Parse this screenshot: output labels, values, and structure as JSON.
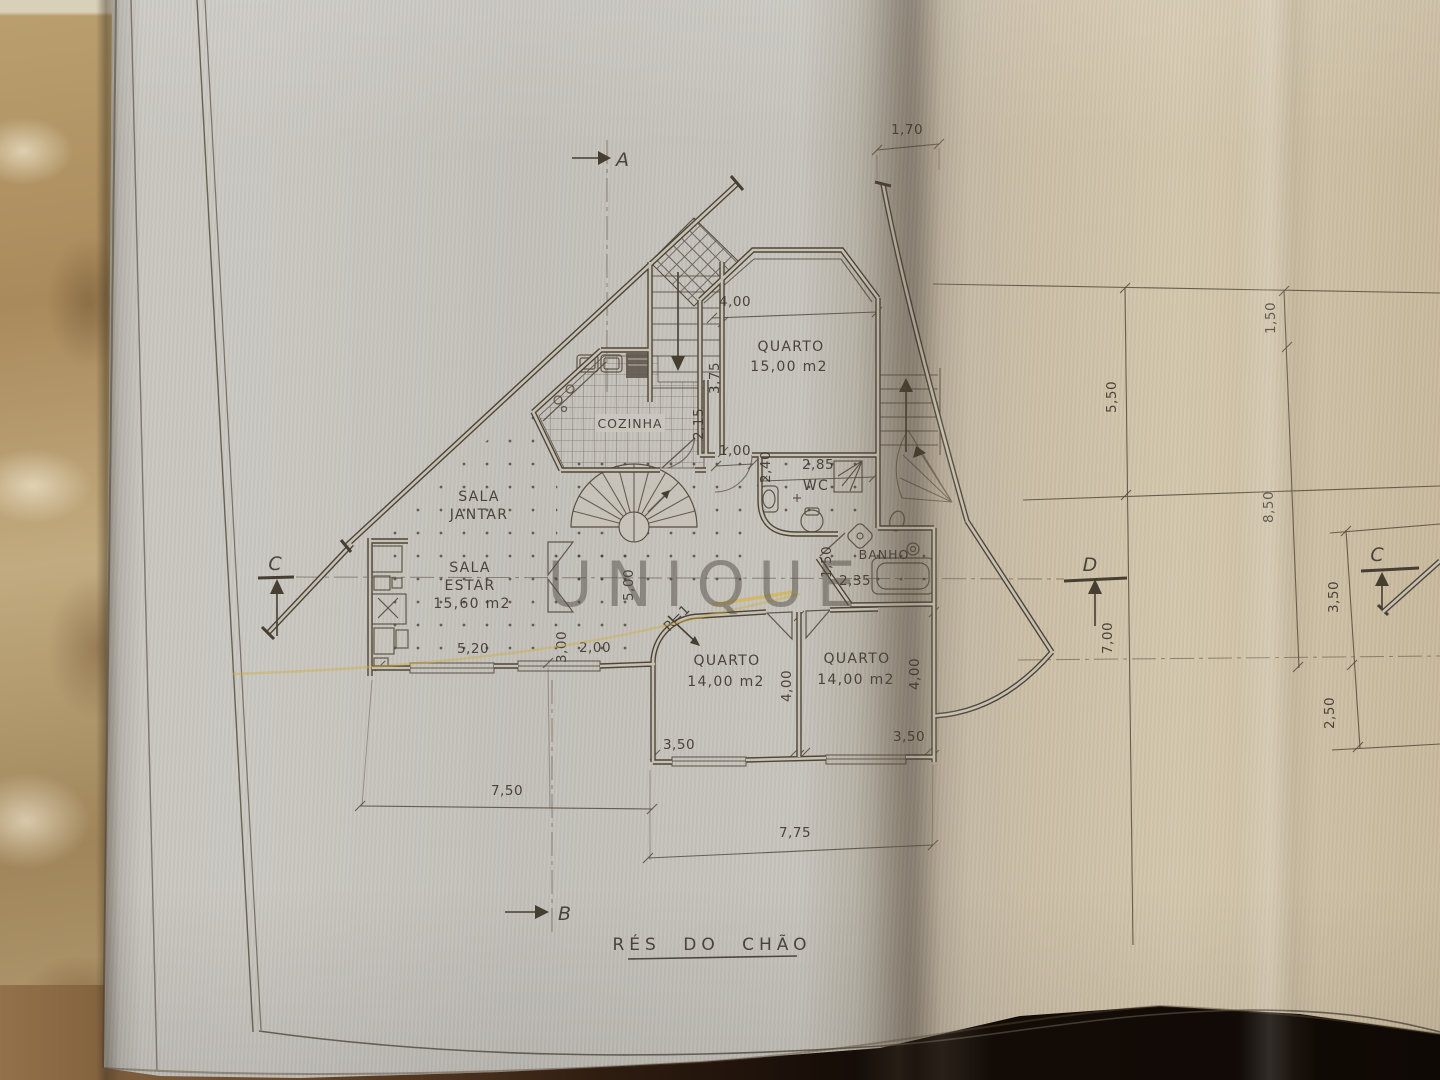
{
  "watermark": "UNIQUE",
  "title": "RÉS DO CHÃO",
  "sections": {
    "a": "A",
    "b": "B",
    "c": "C",
    "d": "D",
    "c_right": "C"
  },
  "rooms": {
    "bedroom_top": {
      "name": "QUARTO",
      "area": "15,00 m2"
    },
    "kitchen": "COZINHA",
    "wc": "WC",
    "bath": "BANHO",
    "dining": {
      "line1": "SALA",
      "line2": "JANTAR"
    },
    "living": {
      "line1": "SALA",
      "line2": "ESTAR",
      "area": "15,60 m2"
    },
    "bedroom_left": {
      "name": "QUARTO",
      "area": "14,00 m2"
    },
    "bedroom_right": {
      "name": "QUARTO",
      "area": "14,00 m2"
    }
  },
  "dims": {
    "top_400": "4,00",
    "depth_375": "3,75",
    "v215": "2,15",
    "h100": "1,00",
    "v240": "2,40",
    "h285": "2,85",
    "top_170": "1,70",
    "h520": "5,20",
    "v300": "3,00",
    "h200": "2,00",
    "v500": "5,00",
    "v150": "1,50",
    "h235": "2,35",
    "v400_mid": "4,00",
    "v400_right": "4,00",
    "h350_left": "3,50",
    "h350_right": "3,50",
    "h750": "7,50",
    "h775": "7,75",
    "radius": "R=1"
  },
  "side_dims": {
    "v150": "1,50",
    "v550": "5,50",
    "v850": "8,50",
    "v700": "7,00",
    "v350": "3,50",
    "v250": "2,50"
  }
}
